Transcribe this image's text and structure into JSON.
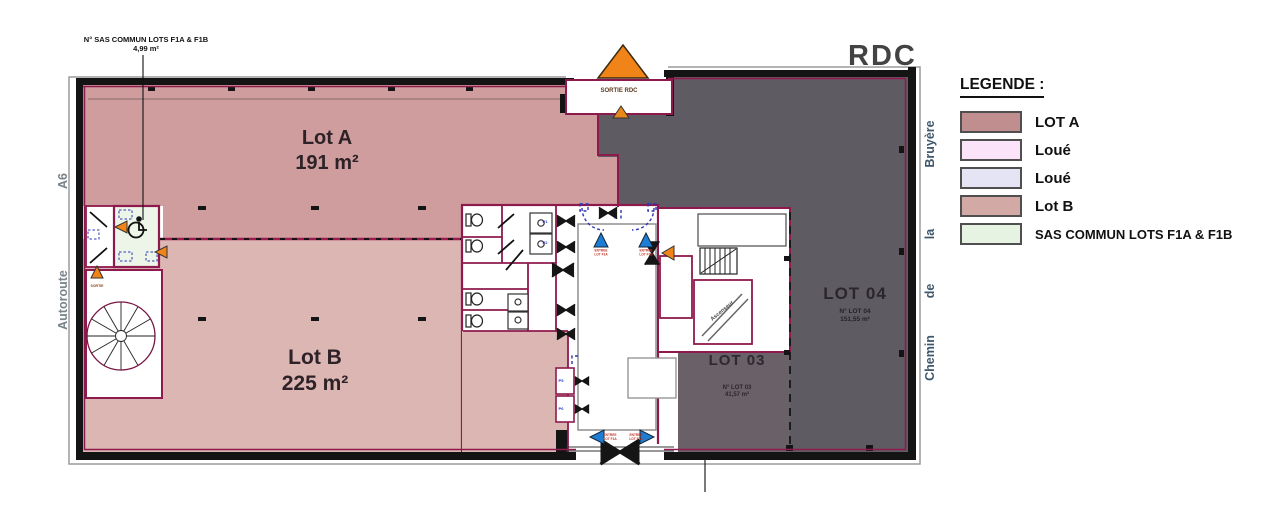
{
  "title": "RDC",
  "legend": {
    "heading": "LEGENDE :",
    "items": [
      {
        "label": "LOT A",
        "color": "#c08e8e"
      },
      {
        "label": "Loué",
        "color": "#fbe4fa"
      },
      {
        "label": "Loué",
        "color": "#e4e4f5"
      },
      {
        "label": "Lot B",
        "color": "#d3a9a5"
      },
      {
        "label": "SAS COMMUN LOTS F1A & F1B",
        "color": "#e7f3e2"
      }
    ]
  },
  "annotation": {
    "line1": "N° SAS COMMUN LOTS F1A & F1B",
    "line2": "4,99 m²"
  },
  "roads": {
    "a6": "A6",
    "autoroute": "Autoroute",
    "right": [
      "Bruyère",
      "la",
      "de",
      "Chemin"
    ]
  },
  "lots": {
    "lot_a": {
      "name": "Lot A",
      "area": "191 m²",
      "color": "#cf9d9d"
    },
    "lot_b": {
      "name": "Lot B",
      "area": "225 m²",
      "color": "#dcb6b3"
    },
    "lot_03": {
      "name": "LOT 03",
      "ref": "N° LOT 03",
      "area": "41,57 m²",
      "color": "#6a6067"
    },
    "lot_04": {
      "name": "LOT 04",
      "ref": "N° LOT 04",
      "area": "151,55 m²",
      "color": "#5f5b62"
    },
    "sas_commun": {
      "color": "#edf5e8"
    }
  },
  "markers": {
    "sortie_rdc": "SORTIE RDC",
    "sortie": "SORTIE",
    "entree": "ENTREE",
    "lot_f1a": "LOT F1A",
    "lot_f1b": "LOT F1B",
    "ascenseur": "Ascenseur",
    "p1": "P1",
    "p2": "P2",
    "p5": "P5",
    "p6": "P6"
  }
}
